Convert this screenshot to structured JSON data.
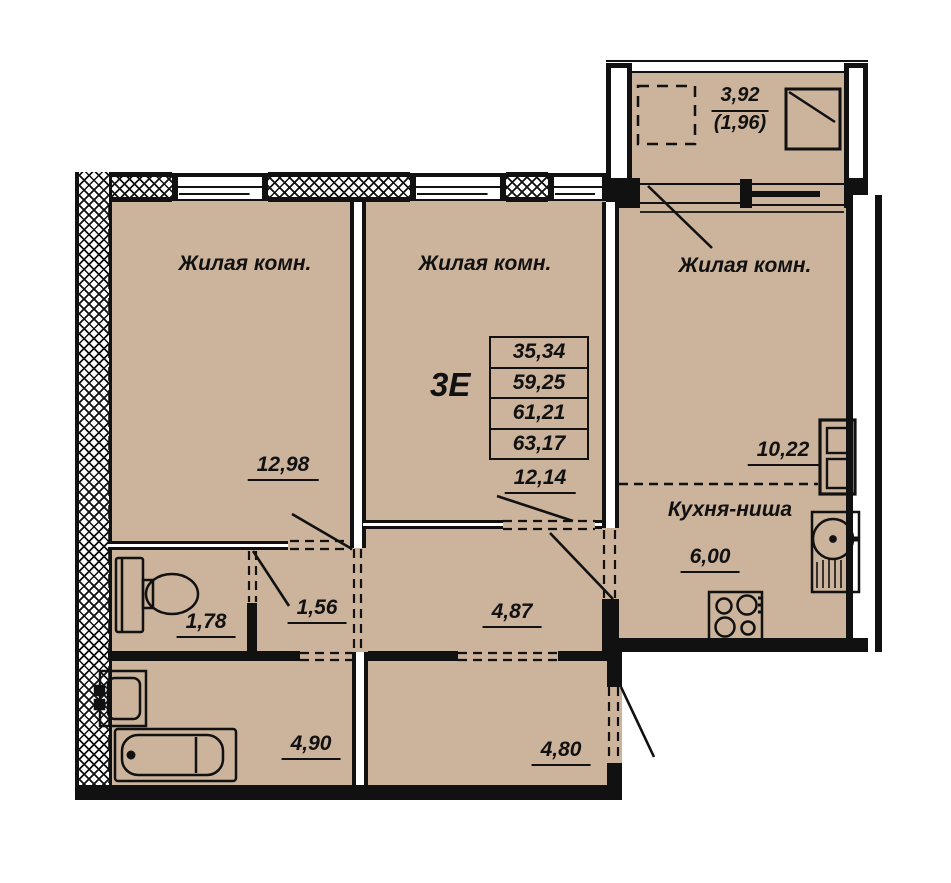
{
  "plan": {
    "type_label": "3Е",
    "areas_table": [
      "35,34",
      "59,25",
      "61,21",
      "63,17"
    ],
    "rooms": {
      "room1": {
        "label": "Жилая комн.",
        "area": "12,98"
      },
      "room2": {
        "label": "Жилая комн.",
        "area": "12,14"
      },
      "room3": {
        "label": "Жилая комн.",
        "area": "10,22"
      },
      "kitchen": {
        "label": "Кухня-ниша",
        "area": "6,00"
      },
      "wc": {
        "area": "1,78"
      },
      "hall_small": {
        "area": "1,56"
      },
      "corridor": {
        "area": "4,87"
      },
      "bathroom": {
        "area": "4,90"
      },
      "hallway": {
        "area": "4,80"
      },
      "balcony": {
        "area": "3,92",
        "area_reduced": "(1,96)"
      }
    },
    "fixtures": [
      "toilet-icon",
      "washbasin-icon",
      "bathtub-icon",
      "kitchen-sink-icon",
      "stove-icon",
      "vent-shaft-icon",
      "window-symbol-icon"
    ],
    "colors": {
      "floor": "#cbb39c",
      "wall": "#111111",
      "background": "#ffffff"
    }
  }
}
